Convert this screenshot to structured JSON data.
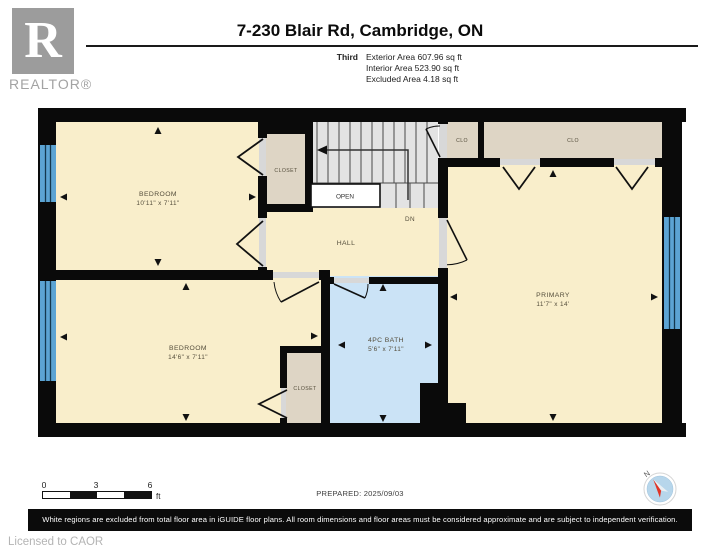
{
  "header": {
    "logo_letter": "R",
    "logo_word": "REALTOR®",
    "title": "7-230 Blair Rd, Cambridge, ON",
    "floor_label": "Third",
    "area_lines": [
      "Exterior Area 607.96 sq ft",
      "Interior Area 523.90 sq ft",
      "Excluded Area 4.18 sq ft"
    ]
  },
  "plan": {
    "rooms": {
      "bedroom1": {
        "name": "BEDROOM",
        "dims": "10'11\" x 7'11\""
      },
      "bedroom2": {
        "name": "BEDROOM",
        "dims": "14'6\" x 7'11\""
      },
      "primary": {
        "name": "PRIMARY",
        "dims": "11'7\" x 14'"
      },
      "bath": {
        "name": "4PC BATH",
        "dims": "5'6\" x 7'11\""
      },
      "hall": {
        "name": "HALL"
      }
    },
    "labels": {
      "closet": "CLOSET",
      "clo": "CLO",
      "open": "OPEN",
      "down": "DN"
    }
  },
  "scale_bar": {
    "ticks": [
      "0",
      "3",
      "6"
    ],
    "unit": "ft"
  },
  "prepared_label": "PREPARED: 2025/09/03",
  "compass": {
    "north": "N"
  },
  "footer": {
    "disclaimer": "White regions are excluded from total floor area in iGUIDE floor plans. All room dimensions and floor areas must be considered approximate and are subject to independent verification.",
    "license": "Licensed to CAOR"
  },
  "colors": {
    "room_fill": "#f9eecb",
    "closet_fill": "#ded5c5",
    "bath_fill": "#cbe3f6",
    "stairs_fill": "#e3e3e3",
    "window_blue": "#5ca4d4",
    "wall": "#0a0a0a",
    "compass_red": "#e03427"
  }
}
